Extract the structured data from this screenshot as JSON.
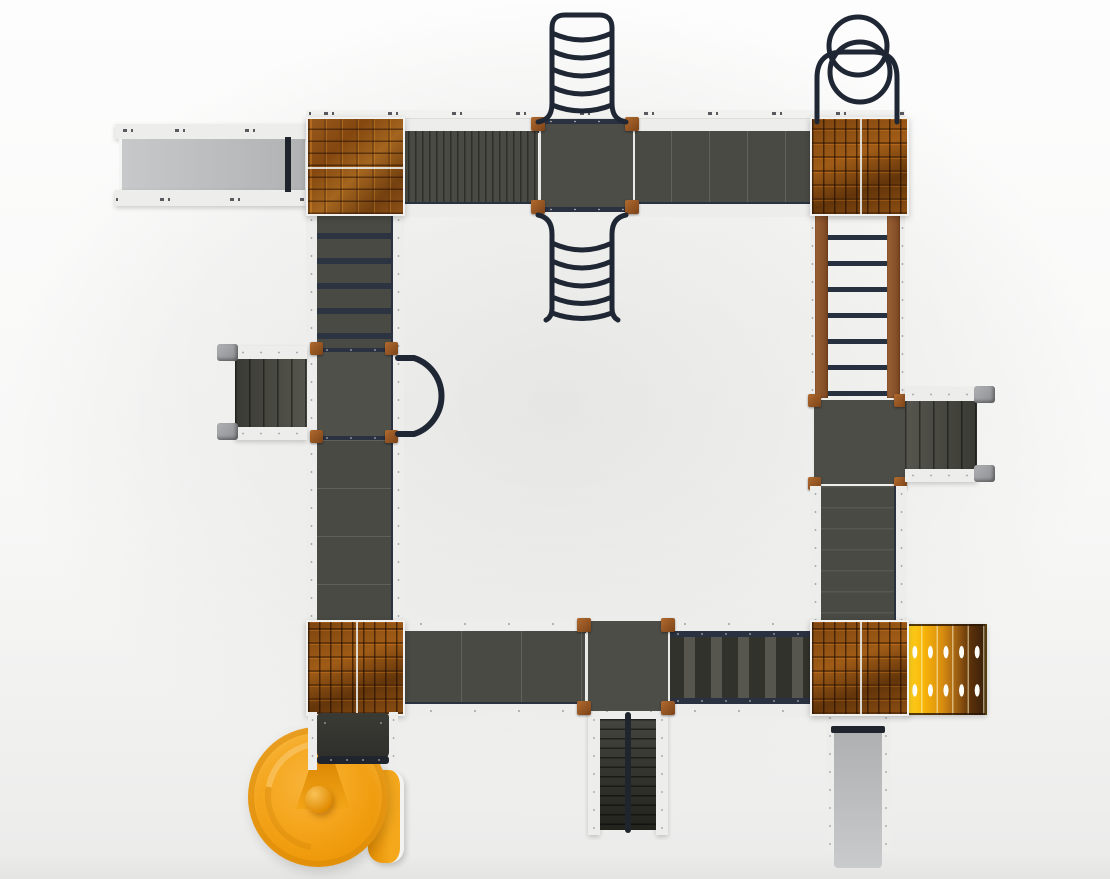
{
  "scene": {
    "type": "playground-structure-top-view-render",
    "description_visible_text": "",
    "components": [
      {
        "name": "straight-slide-top-left",
        "kind": "slide",
        "color_key": "slide_gray"
      },
      {
        "name": "tower-top-left",
        "kind": "tower-brick-roof",
        "brick_orientation": "horizontal"
      },
      {
        "name": "tower-top-right",
        "kind": "tower-brick-roof",
        "brick_orientation": "vertical"
      },
      {
        "name": "tower-bottom-left",
        "kind": "tower-brick-roof",
        "brick_orientation": "vertical"
      },
      {
        "name": "tower-bottom-right",
        "kind": "tower-brick-roof",
        "brick_orientation": "vertical"
      },
      {
        "name": "loop-ladder-top-outer",
        "kind": "overhead-loop-climber",
        "loops": 5
      },
      {
        "name": "loop-ladder-top-inner",
        "kind": "overhead-loop-climber",
        "loops": 5
      },
      {
        "name": "double-ring-climber",
        "kind": "ring-climber",
        "rings": 2
      },
      {
        "name": "vertical-ladder-right",
        "kind": "wood-ladder",
        "rungs": 7
      },
      {
        "name": "climb-ramp-left",
        "kind": "bar-ramp",
        "bars": 5
      },
      {
        "name": "arch-climber-mid-left",
        "kind": "arch-tube"
      },
      {
        "name": "stairs-left",
        "kind": "stairs"
      },
      {
        "name": "stairs-right",
        "kind": "stairs"
      },
      {
        "name": "stairs-bottom-center",
        "kind": "double-stairs"
      },
      {
        "name": "straight-slide-bottom-right",
        "kind": "slide",
        "color_key": "slide_gray"
      },
      {
        "name": "spiral-slide-bottom-left",
        "kind": "spiral-slide",
        "color_key": "spiral_orange"
      },
      {
        "name": "climb-panel-yellow",
        "kind": "hole-panel",
        "slats": 5
      },
      {
        "name": "walkway-top",
        "kind": "bridge"
      },
      {
        "name": "walkway-bottom",
        "kind": "bridge"
      },
      {
        "name": "walkway-left",
        "kind": "bridge"
      },
      {
        "name": "walkway-right",
        "kind": "bridge"
      }
    ]
  },
  "colors": {
    "background": "#f5f5f4",
    "deck": "#4a4a44",
    "deck_dark": "#3a3a34",
    "rail_white": "#ededec",
    "rail_navy": "#2a3140",
    "tube_navy": "#1f2633",
    "wood_post": "#9a5b2a",
    "wood_rail": "#8a5631",
    "brick_base": "#8a4c15",
    "brick_highlight": "#c0762a",
    "slide_gray": "#bfc1c3",
    "spiral_orange": "#f3a114",
    "spiral_orange_dark": "#e18c02",
    "panel_yellow": "#ffd31e",
    "panel_brown": "#38200a",
    "handrail_gray": "#9b9da0",
    "stair_black": "#20242c"
  }
}
